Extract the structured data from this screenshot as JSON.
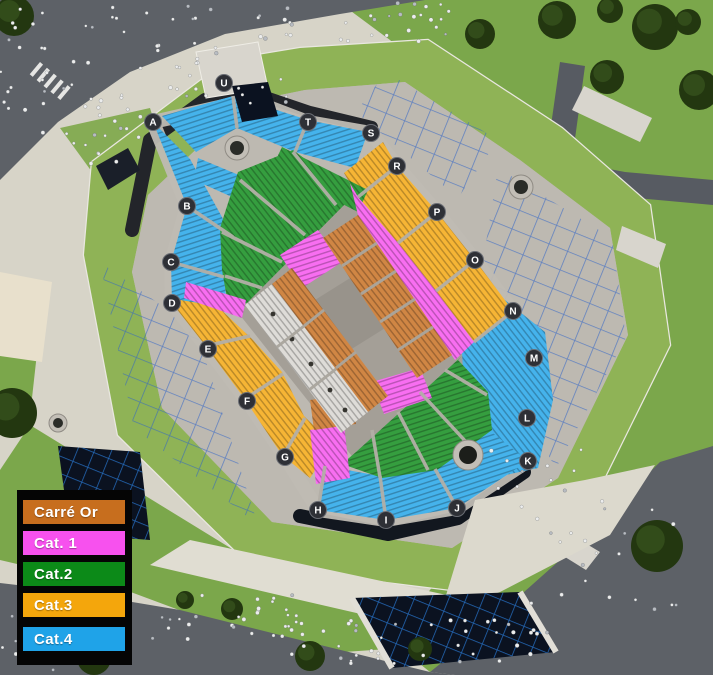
{
  "legend": {
    "items": [
      {
        "label": "Carré Or",
        "category": "carre-or",
        "color": "#c76e1e"
      },
      {
        "label": "Cat. 1",
        "category": "cat1",
        "color": "#f751ee"
      },
      {
        "label": "Cat.2",
        "category": "cat2",
        "color": "#0c8a18"
      },
      {
        "label": "Cat.3",
        "category": "cat3",
        "color": "#f4a60c"
      },
      {
        "label": "Cat.4",
        "category": "cat4",
        "color": "#1fa3e8"
      }
    ],
    "background": "#050505",
    "text_color": "#ffffff"
  },
  "arena": {
    "sections": [
      {
        "id": "A",
        "category": "cat4"
      },
      {
        "id": "B",
        "category": "cat4"
      },
      {
        "id": "C",
        "category": "cat4"
      },
      {
        "id": "D",
        "category": "cat3"
      },
      {
        "id": "E",
        "category": "cat3"
      },
      {
        "id": "F",
        "category": "cat3"
      },
      {
        "id": "G",
        "category": "cat3"
      },
      {
        "id": "H",
        "category": "cat4"
      },
      {
        "id": "I",
        "category": "cat4"
      },
      {
        "id": "J",
        "category": "cat4"
      },
      {
        "id": "K",
        "category": "cat4"
      },
      {
        "id": "L",
        "category": "cat4"
      },
      {
        "id": "M",
        "category": "cat4"
      },
      {
        "id": "N",
        "category": "cat3"
      },
      {
        "id": "O",
        "category": "cat3"
      },
      {
        "id": "P",
        "category": "cat3"
      },
      {
        "id": "R",
        "category": "cat3"
      },
      {
        "id": "S",
        "category": "cat4"
      },
      {
        "id": "T",
        "category": "cat4"
      },
      {
        "id": "U",
        "category": "cat4"
      }
    ]
  },
  "palette": {
    "street": "#5d6167",
    "plaza": "#d7d4c8",
    "path_light": "#e0ddd2",
    "grass": "#7ba74b",
    "grass_roof": "#8fb356",
    "tree": "#233710",
    "tree_light": "#36511d",
    "concrete": "#bdb9b1",
    "concrete_light": "#d8d5cd",
    "dark_rim": "#23252a",
    "glass": "#0b1220",
    "scaffold_blue": "#2f64c8",
    "floor": "#a49f97",
    "uncolored_seats": "#d7d5d0"
  }
}
